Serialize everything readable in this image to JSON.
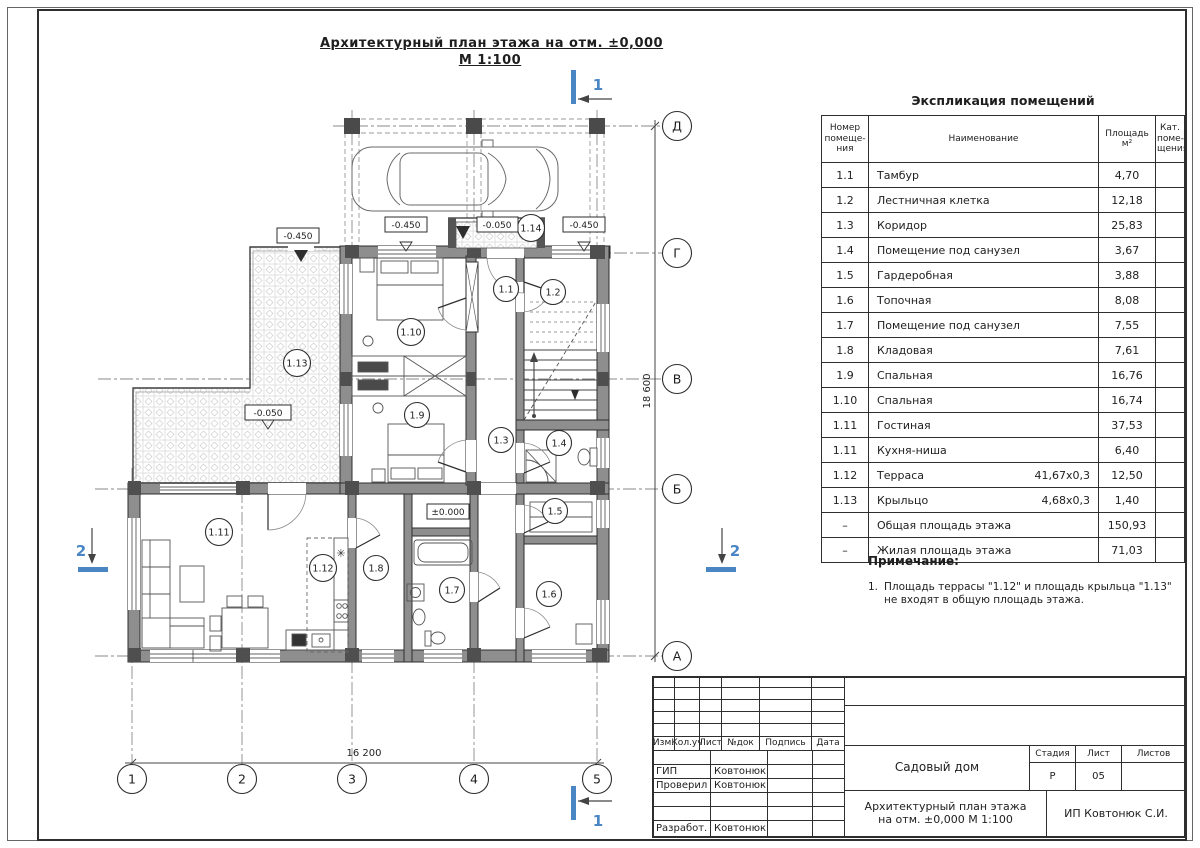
{
  "colors": {
    "accent_blue": "#4a86c4",
    "wall_fill": "#8e8e8e",
    "line": "#2e2e2e"
  },
  "title": {
    "line1": "Архитектурный план этажа на отм. ±0,000",
    "line2": "М 1:100"
  },
  "explication": {
    "title": "Экспликация помещений",
    "headers": {
      "num": "Номер\nпомеще-\nния",
      "name": "Наименование",
      "area": "Площадь\nм²",
      "cat": "Кат.\nпоме-\nщения"
    },
    "rows": [
      {
        "num": "1.1",
        "name": "Тамбур",
        "size": "",
        "area": "4,70",
        "cat": ""
      },
      {
        "num": "1.2",
        "name": "Лестничная клетка",
        "size": "",
        "area": "12,18",
        "cat": ""
      },
      {
        "num": "1.3",
        "name": "Коридор",
        "size": "",
        "area": "25,83",
        "cat": ""
      },
      {
        "num": "1.4",
        "name": "Помещение под санузел",
        "size": "",
        "area": "3,67",
        "cat": ""
      },
      {
        "num": "1.5",
        "name": "Гардеробная",
        "size": "",
        "area": "3,88",
        "cat": ""
      },
      {
        "num": "1.6",
        "name": "Топочная",
        "size": "",
        "area": "8,08",
        "cat": ""
      },
      {
        "num": "1.7",
        "name": "Помещение под санузел",
        "size": "",
        "area": "7,55",
        "cat": ""
      },
      {
        "num": "1.8",
        "name": "Кладовая",
        "size": "",
        "area": "7,61",
        "cat": ""
      },
      {
        "num": "1.9",
        "name": "Спальная",
        "size": "",
        "area": "16,76",
        "cat": ""
      },
      {
        "num": "1.10",
        "name": "Спальная",
        "size": "",
        "area": "16,74",
        "cat": ""
      },
      {
        "num": "1.11",
        "name": "Гостиная",
        "size": "",
        "area": "37,53",
        "cat": ""
      },
      {
        "num": "1.11",
        "name": "Кухня-ниша",
        "size": "",
        "area": "6,40",
        "cat": ""
      },
      {
        "num": "1.12",
        "name": "Терраса",
        "size": "41,67x0,3",
        "area": "12,50",
        "cat": ""
      },
      {
        "num": "1.13",
        "name": "Крыльцо",
        "size": "4,68x0,3",
        "area": "1,40",
        "cat": ""
      },
      {
        "num": "–",
        "name": "Общая площадь этажа",
        "size": "",
        "area": "150,93",
        "cat": ""
      },
      {
        "num": "–",
        "name": "Жилая площадь этажа",
        "size": "",
        "area": "71,03",
        "cat": ""
      }
    ]
  },
  "note": {
    "title": "Примечание:",
    "num": "1.",
    "text": "Площадь террасы \"1.12\" и площадь крыльца \"1.13\"\nне входят в общую площадь этажа."
  },
  "titleblock": {
    "rev_headers": [
      "Изм.",
      "Кол.уч",
      "Лист",
      "№док",
      "Подпись",
      "Дата"
    ],
    "staff": [
      {
        "role": "ГИП",
        "name": "Ковтонюк"
      },
      {
        "role": "Проверил",
        "name": "Ковтонюк"
      },
      {
        "role": "Разработ.",
        "name": "Ковтонюк"
      }
    ],
    "project": "Садовый дом",
    "stage_label": "Стадия",
    "list_label": "Лист",
    "lists_label": "Листов",
    "stage": "Р",
    "list_no": "05",
    "lists": "",
    "doc_title": "Архитектурный план этажа\nна отм. ±0,000 М 1:100",
    "company": "ИП Ковтонюк С.И."
  },
  "plan": {
    "dim_bottom": "16 200",
    "dim_right": "18 600",
    "col_axes": [
      {
        "label": "1"
      },
      {
        "label": "2"
      },
      {
        "label": "3"
      },
      {
        "label": "4"
      },
      {
        "label": "5"
      }
    ],
    "row_axes": [
      {
        "label": "Д"
      },
      {
        "label": "Г"
      },
      {
        "label": "В"
      },
      {
        "label": "Б"
      },
      {
        "label": "А"
      }
    ],
    "rooms": [
      {
        "id": "1.1"
      },
      {
        "id": "1.2"
      },
      {
        "id": "1.3"
      },
      {
        "id": "1.4"
      },
      {
        "id": "1.5"
      },
      {
        "id": "1.6"
      },
      {
        "id": "1.7"
      },
      {
        "id": "1.8"
      },
      {
        "id": "1.9"
      },
      {
        "id": "1.10"
      },
      {
        "id": "1.11"
      },
      {
        "id": "1.12"
      },
      {
        "id": "1.13"
      },
      {
        "id": "1.14"
      }
    ],
    "elevations": [
      {
        "v": "-0.450"
      },
      {
        "v": "-0.450"
      },
      {
        "v": "-0.050"
      },
      {
        "v": "-0.450"
      },
      {
        "v": "-0.050"
      },
      {
        "v": "±0.000"
      }
    ],
    "sections": {
      "n1": "1",
      "n2": "2"
    },
    "fridge_icon": "✳"
  }
}
